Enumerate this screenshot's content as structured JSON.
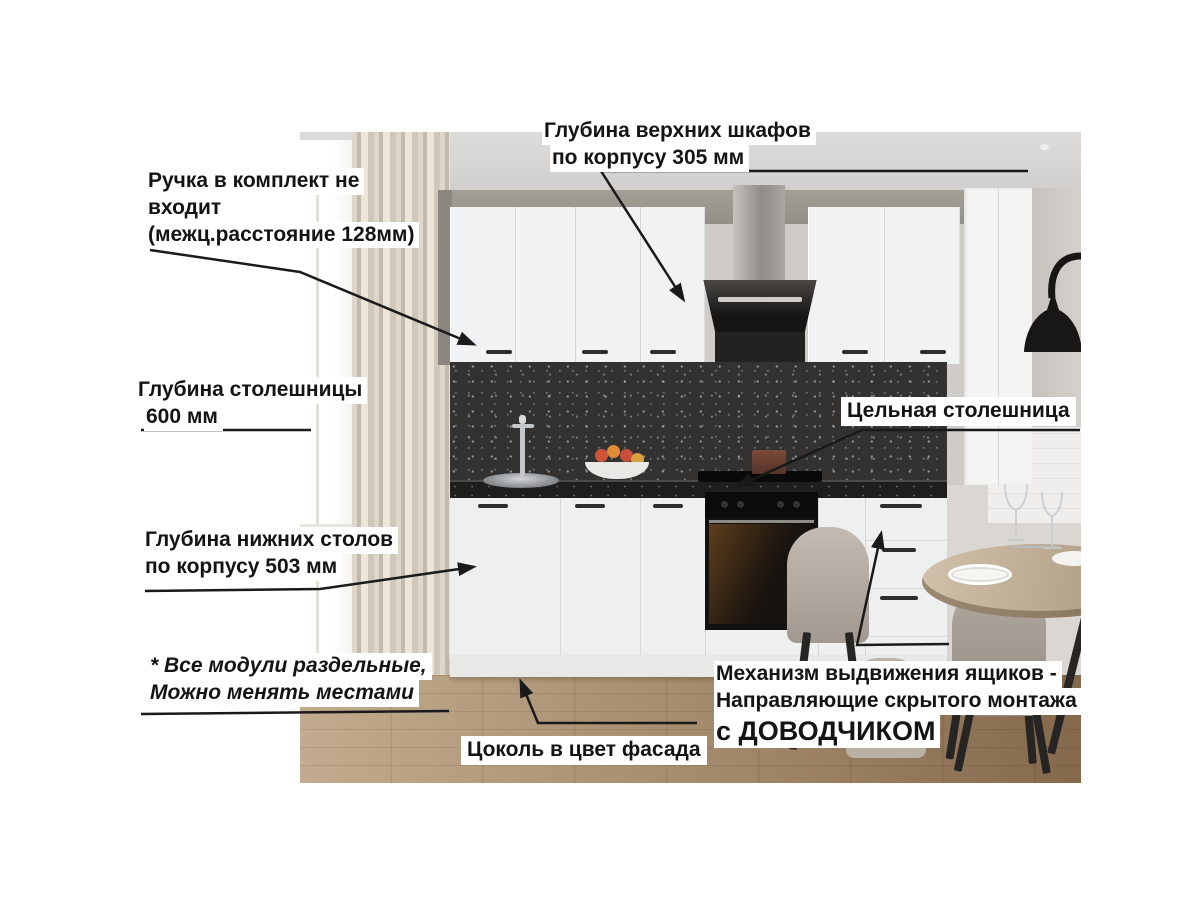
{
  "colors": {
    "label_text": "#141414",
    "label_bg": "#ffffff",
    "arrow": "#1a1a1a"
  },
  "labels": {
    "upper_depth": {
      "line1": "Глубина верхних шкафов",
      "line2": "по корпусу 305 мм"
    },
    "handle_note": {
      "line1": "Ручка в комплект не",
      "line2": "входит",
      "line3": "(межц.расстояние 128мм)"
    },
    "countertop_depth": {
      "line1": "Глубина столешницы",
      "line2": "600 мм"
    },
    "base_depth": {
      "line1": "Глубина нижних столов",
      "line2": "по корпусу 503 мм"
    },
    "modules_note": {
      "line1": "* Все модули раздельные,",
      "line2": "Можно менять местами"
    },
    "plinth_note": {
      "text": "Цоколь в цвет фасада"
    },
    "solid_countertop": {
      "text": "Цельная столешница"
    },
    "drawer_mechanism": {
      "line1": "Механизм выдвижения ящиков -",
      "line2": "Направляющие скрытого монтажа",
      "line3": "с ДОВОДЧИКОМ"
    }
  }
}
